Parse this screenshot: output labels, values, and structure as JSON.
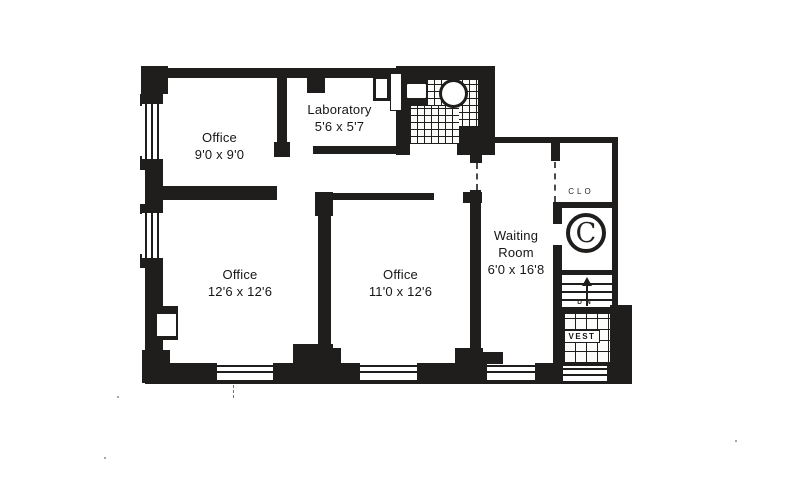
{
  "type": "floor-plan",
  "colors": {
    "wall": "#201e1c",
    "paper": "#ffffff",
    "ink": "#161616"
  },
  "rooms": {
    "office_top_left": {
      "name": "Office",
      "dims": "9'0 x 9'0"
    },
    "laboratory": {
      "name": "Laboratory",
      "dims": "5'6 x 5'7"
    },
    "office_bottom_left": {
      "name": "Office",
      "dims": "12'6 x 12'6"
    },
    "office_bottom_middle": {
      "name": "Office",
      "dims": "11'0 x 12'6"
    },
    "waiting_room": {
      "line1": "Waiting",
      "line2": "Room",
      "dims": "6'0 x 16'8"
    },
    "closet": {
      "label": "CLO"
    },
    "shaft": {
      "label": "C"
    },
    "stairs": {
      "label": "DN"
    },
    "vestibule": {
      "label": "VEST"
    }
  }
}
